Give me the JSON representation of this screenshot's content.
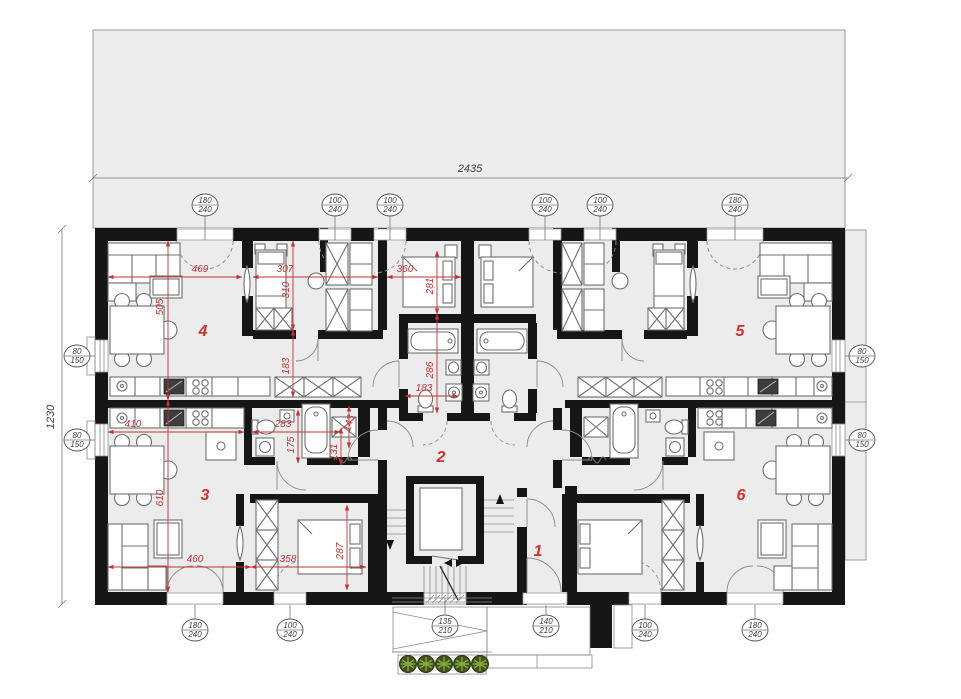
{
  "drawing": {
    "overall": {
      "width": "2435",
      "height": "1230"
    },
    "rooms": {
      "hall": "1",
      "corridor": "2",
      "apt3": "3",
      "apt4": "4",
      "apt5": "5",
      "apt6": "6"
    },
    "openings": {
      "top": [
        {
          "w": "180",
          "h": "240"
        },
        {
          "w": "100",
          "h": "240"
        },
        {
          "w": "100",
          "h": "240"
        },
        {
          "w": "100",
          "h": "240"
        },
        {
          "w": "100",
          "h": "240"
        },
        {
          "w": "180",
          "h": "240"
        }
      ],
      "left": [
        {
          "w": "80",
          "h": "150"
        },
        {
          "w": "80",
          "h": "150"
        }
      ],
      "right": [
        {
          "w": "80",
          "h": "150"
        },
        {
          "w": "80",
          "h": "150"
        }
      ],
      "bottom": [
        {
          "w": "180",
          "h": "240"
        },
        {
          "w": "100",
          "h": "240"
        },
        {
          "w": "135",
          "h": "210"
        },
        {
          "w": "140",
          "h": "210"
        },
        {
          "w": "100",
          "h": "240"
        },
        {
          "w": "180",
          "h": "240"
        }
      ]
    },
    "dims": {
      "living4_width": "469",
      "bed4_width": "307",
      "bedC_width": "360",
      "living4_height": "505",
      "bed4_height": "310",
      "hall4_height": "183",
      "bedC_height": "281",
      "bathC_height": "286",
      "bathC_width": "183",
      "kitchen3_width": "410",
      "bath3_width": "283",
      "bath3_height": "175",
      "niche3_width": "143",
      "niche3_height": "131",
      "living3_height": "610",
      "living3_width": "460",
      "bed3_width": "358",
      "bed3_height": "287"
    }
  },
  "colors": {
    "wall": "#161616",
    "floor": "#ececec",
    "terrace": "#ededed",
    "dimension_red": "#c23434",
    "line_gray": "#6f6f6f",
    "plant_dark": "#42531f",
    "plant_light": "#86a93e"
  }
}
